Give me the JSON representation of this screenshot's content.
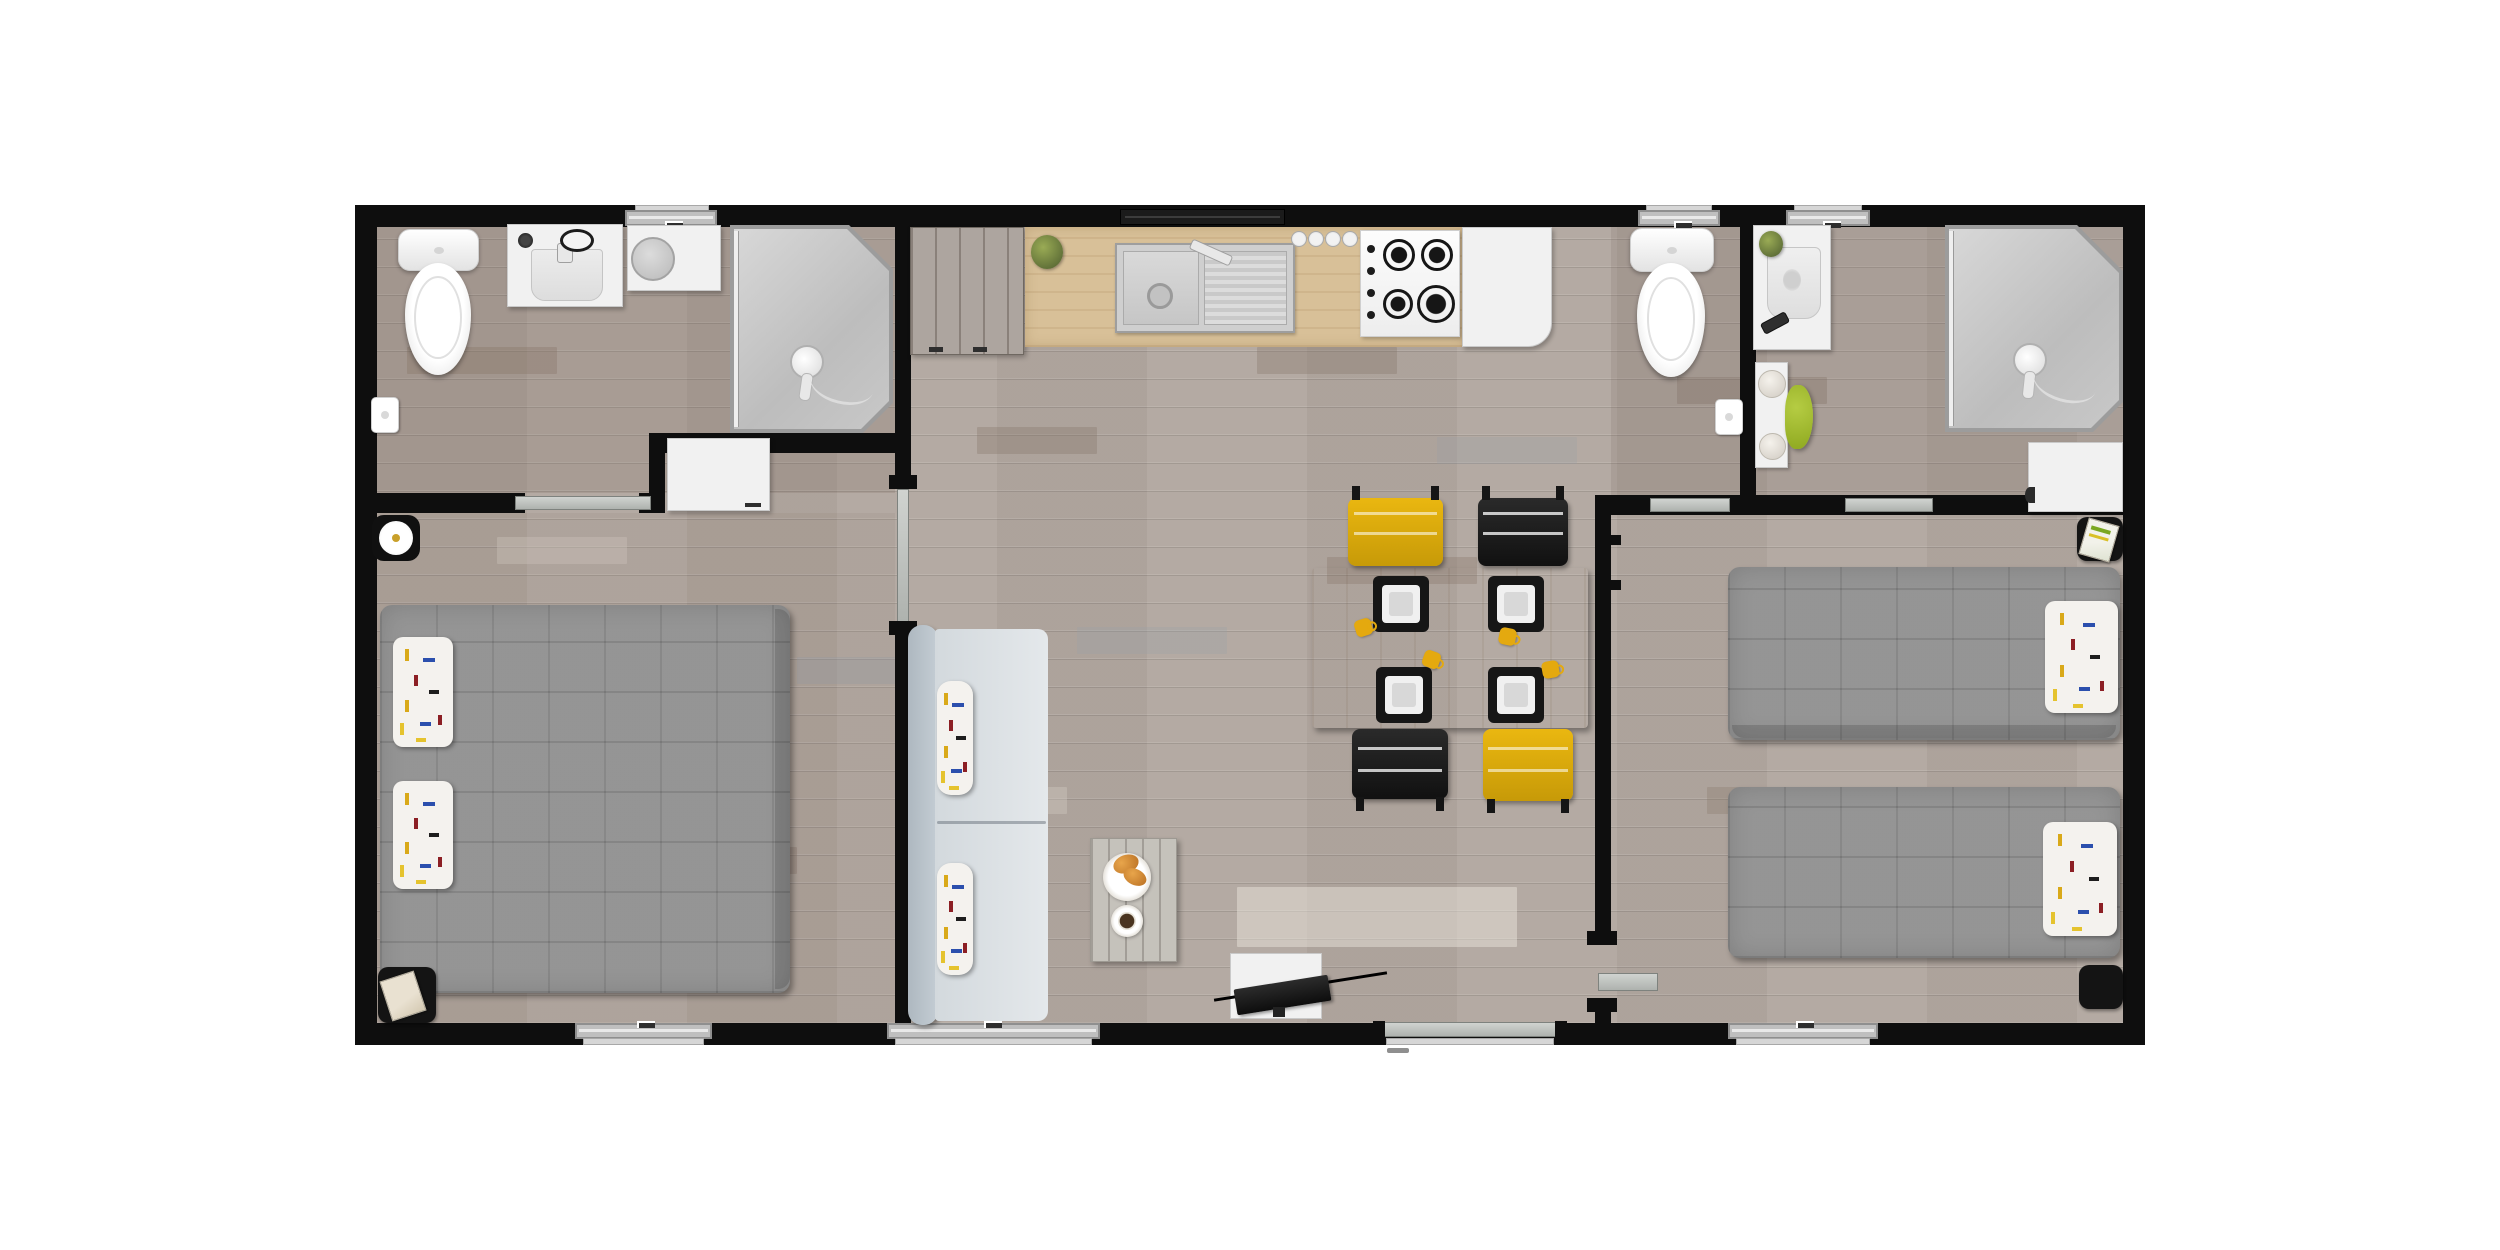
{
  "meta": {
    "title": "Mobile home floor plan — top-down 3D render",
    "view": "top view",
    "background": "#ffffff"
  },
  "colors": {
    "wall": "#0e0e0e",
    "floor": "#b3a9a2",
    "window_gray": "#bfbfbf",
    "door_gray": "#b9bdb9",
    "cabinet_white": "#f1f1f1",
    "counter_wood": "#d8c098",
    "table_wood": "#c9ad85",
    "duvet": "#8f8f8f",
    "pillow": "#f4f2ee",
    "sofa_back": "#b9c2c9",
    "sofa_seat": "#dde2e6",
    "chair_yellow": "#eab710",
    "chair_black": "#1d1d1d",
    "cup_yellow": "#e4a90f",
    "accent_green": "#9ab32a",
    "tv_black": "#141414"
  },
  "rooms": [
    {
      "id": "bathroom-left",
      "name": "Left bathroom",
      "furniture": [
        "toilet",
        "vanity washbasin",
        "countertop round basin",
        "corner shower with glass door",
        "toilet paper holder",
        "sliding door",
        "window"
      ]
    },
    {
      "id": "bedroom-left",
      "name": "Left bedroom (double)",
      "furniture": [
        "double bed with gray quilted duvet",
        "2 confetti pillows",
        "white wardrobe",
        "wall clock",
        "black bedside mat with magazine",
        "window",
        "sliding door"
      ]
    },
    {
      "id": "living-kitchen",
      "name": "Living room / kitchen",
      "furniture": [
        "tall gray cabinet",
        "oak kitchen counter",
        "sink with drainer and faucet",
        "row of 4 knobs",
        "4-burner gas hob",
        "fridge",
        "potted plant",
        "dining table",
        "4 black placemats with white plates",
        "4 yellow mugs",
        "2 yellow chairs",
        "2 black chairs",
        "sofa with 2 confetti cushions",
        "plank coffee table",
        "plate with croissants",
        "coffee cup",
        "TV on white cabinet",
        "entry door",
        "2 windows"
      ]
    },
    {
      "id": "wc-right",
      "name": "Right WC",
      "furniture": [
        "toilet",
        "toilet paper holder",
        "sliding door",
        "window"
      ]
    },
    {
      "id": "bathroom-right",
      "name": "Right bathroom",
      "furniture": [
        "washbasin counter",
        "potted plant",
        "shelf with 2 bowls",
        "green stool",
        "corner shower with glass door",
        "white storage cabinet",
        "sliding door",
        "window"
      ]
    },
    {
      "id": "bedroom-right",
      "name": "Right bedroom (twin)",
      "furniture": [
        "2 single beds with gray quilted duvets",
        "2 confetti pillows",
        "black mat with magazine",
        "black bedside mat",
        "window",
        "door with threshold"
      ]
    }
  ]
}
